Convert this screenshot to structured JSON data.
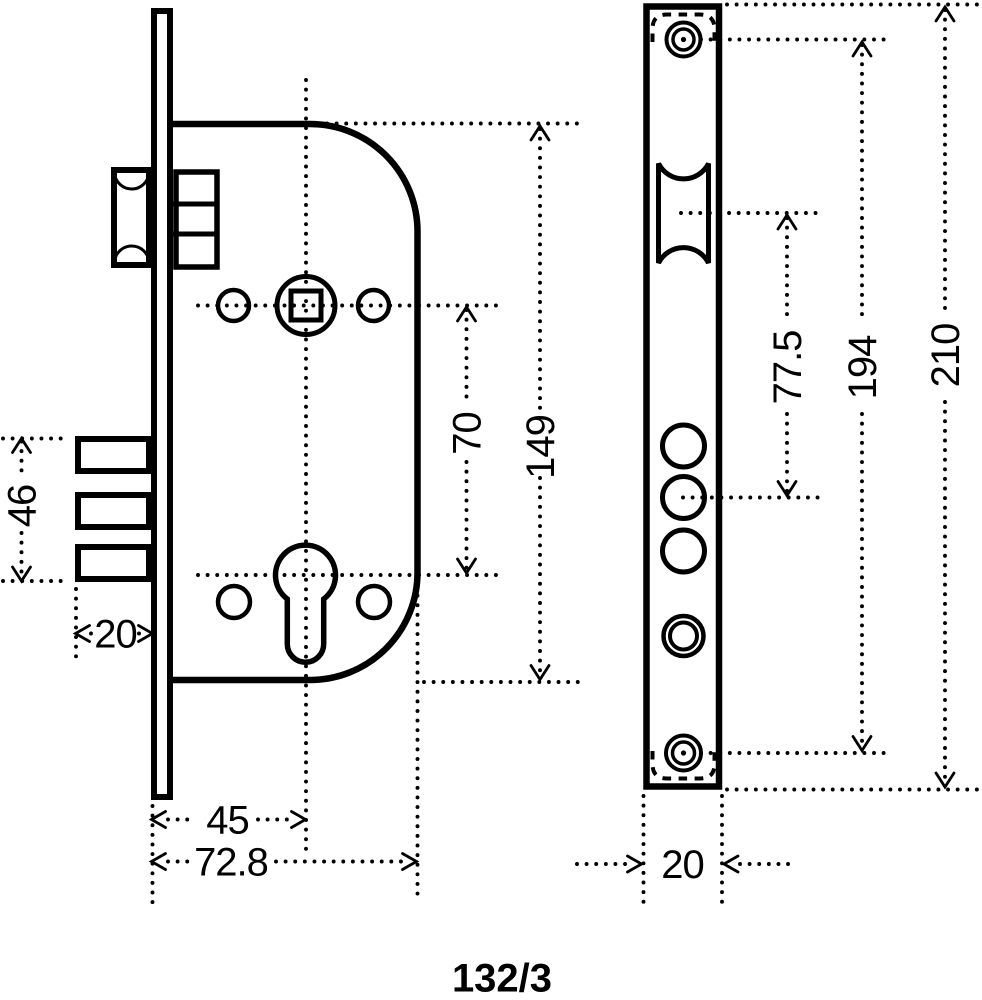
{
  "drawing": {
    "title": "mortise lock technical drawing",
    "product_code": "132/3",
    "line_color": "#000000",
    "background_color": "#ffffff",
    "side_view": {
      "description": "lock body side view",
      "dims": {
        "deadbolt_block_height": "46",
        "deadbolt_throw": "20",
        "spindle_to_cylinder": "70",
        "body_height": "149",
        "backset": "45",
        "body_depth": "72.8"
      }
    },
    "front_view": {
      "description": "faceplate front view",
      "dims": {
        "roller_to_deadbolt": "77.5",
        "screw_spacing": "194",
        "plate_height": "210",
        "plate_width": "20"
      }
    }
  }
}
